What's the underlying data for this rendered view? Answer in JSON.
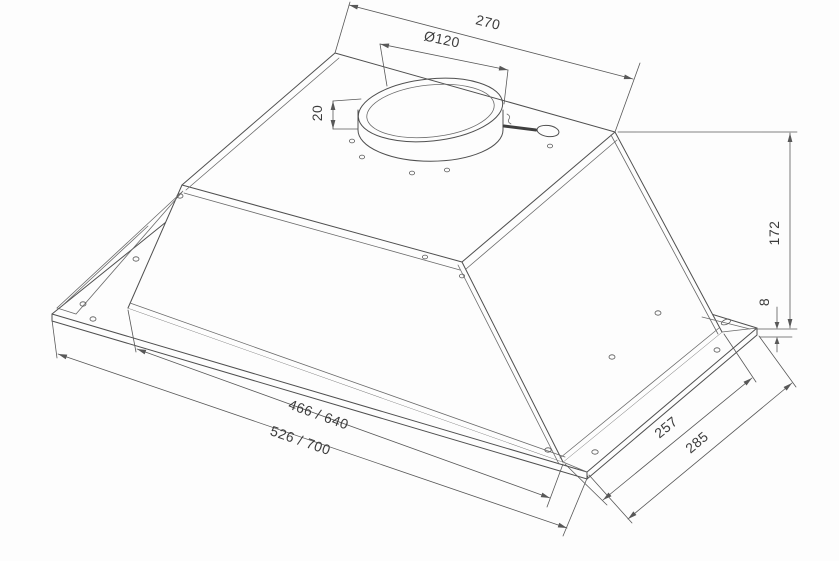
{
  "drawing": {
    "subject": "built-in cooker hood canopy, isometric technical drawing",
    "colors": {
      "line": "#4f4f4f",
      "dimension_line": "#585858",
      "text": "#3c3c3c",
      "background": "#fdfdfd"
    },
    "dims": {
      "top_depth": "270",
      "duct_diameter": "Ø120",
      "collar_height": "20",
      "body_height": "172",
      "flange_lip": "8",
      "inner_width": "466 / 640",
      "outer_width": "526 / 700",
      "inner_depth": "257",
      "outer_depth": "285"
    }
  }
}
